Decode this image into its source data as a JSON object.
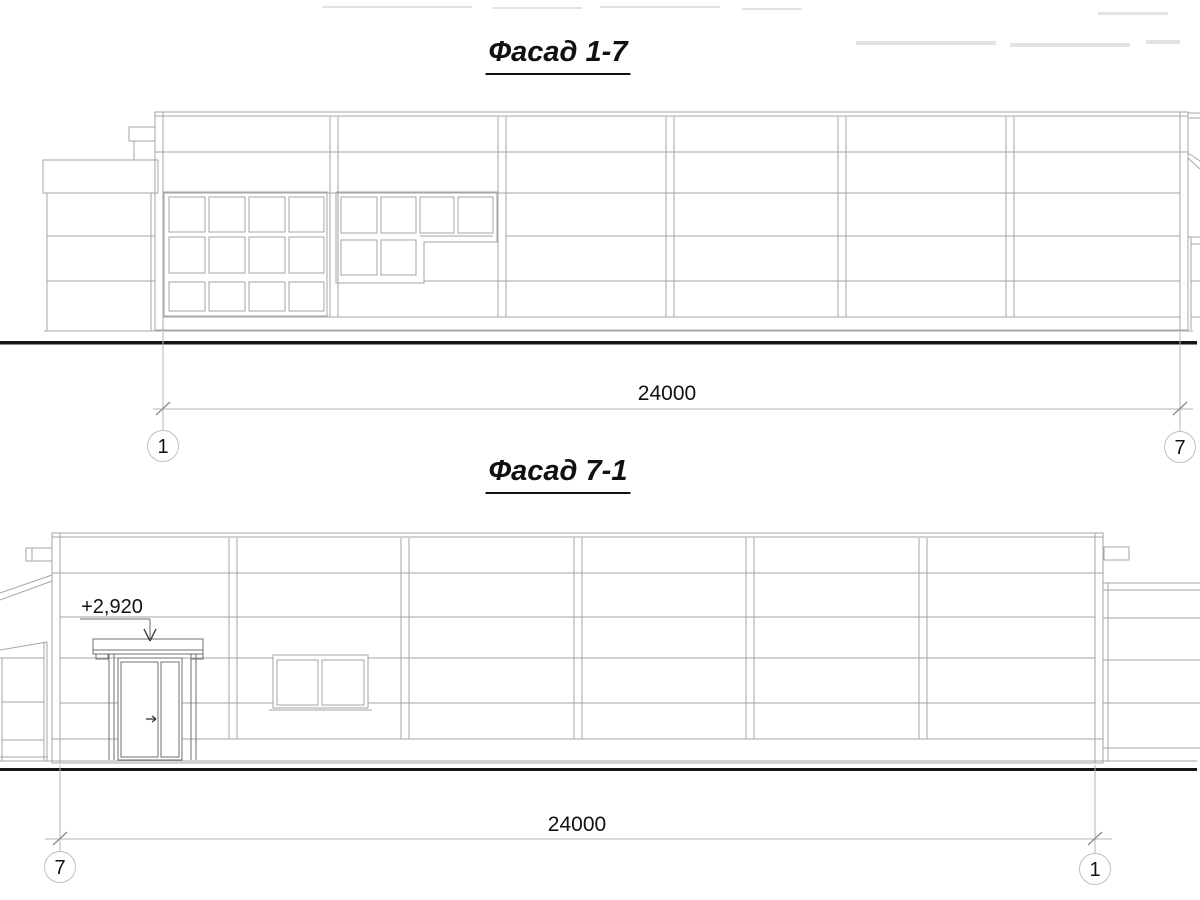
{
  "facade_top": {
    "title": "Фасад 1-7",
    "dimension": "24000",
    "axis_left": "1",
    "axis_right": "7"
  },
  "facade_bottom": {
    "title": "Фасад 7-1",
    "dimension": "24000",
    "axis_left": "7",
    "axis_right": "1",
    "elevation_mark": "+2,920"
  },
  "colors": {
    "line": "#a6a6a6",
    "line_dark": "#6f6f6f",
    "dimension_line": "#b4b4b4",
    "ground_line": "#161616",
    "text": "#111111",
    "axis_circle": "#c0c0c0"
  }
}
